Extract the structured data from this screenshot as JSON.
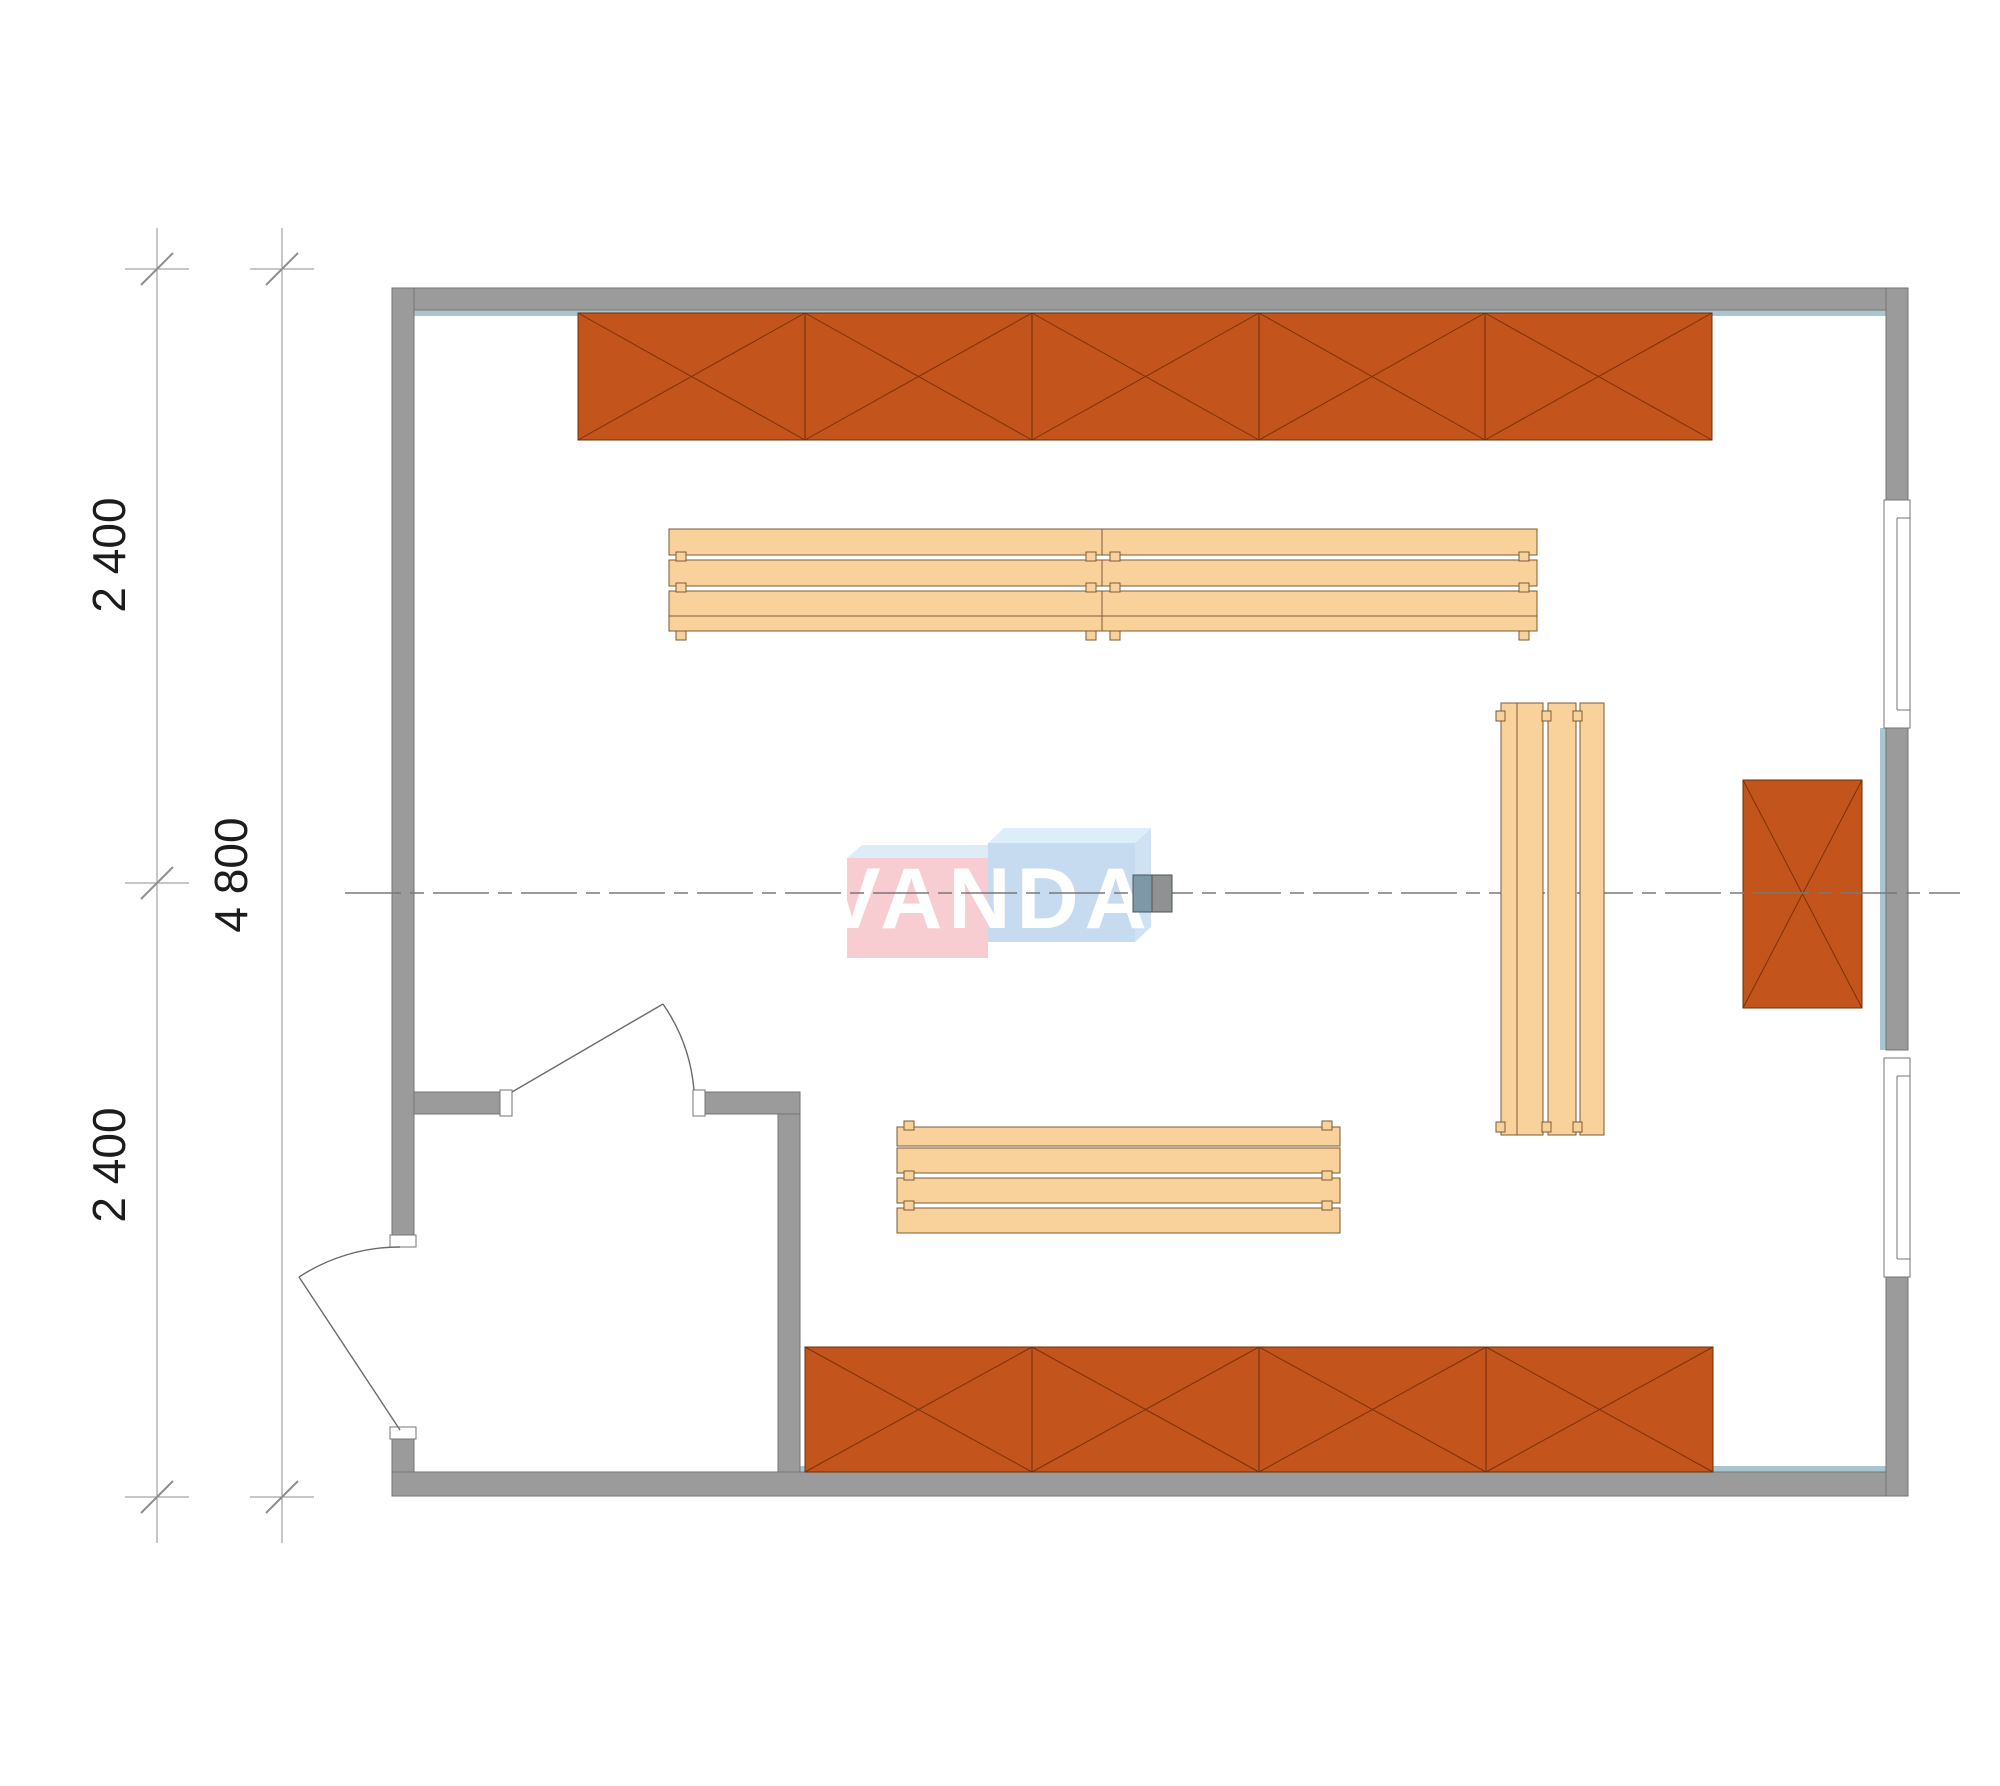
{
  "drawing": {
    "type": "sauna floor plan",
    "view": "top-down"
  },
  "watermark": {
    "text": "VANDA"
  },
  "dimensions": {
    "overall": "4 800",
    "top_segment": "2 400",
    "bottom_segment": "2 400"
  },
  "inventory": {
    "top_cabinet_units": 5,
    "bottom_cabinet_units": 4,
    "wall_cabinet_units": 1,
    "benches": 4,
    "doors": 2,
    "windows": 2
  },
  "colors": {
    "wall": "#9b9b9b",
    "wall_outline": "#747474",
    "cabinet": "#c2541c",
    "cabinet_line": "#7c3208",
    "bench": "#f9d29b",
    "bench_outline": "#7a5a34",
    "lining": "#a9c6d0",
    "logo_pink": "#f7cdd2",
    "logo_pink_top": "#dcedf8",
    "logo_blue": "#c6dbf0",
    "logo_blue_top": "#ddeefb",
    "logo_blue_side": "#cfe2f4",
    "stove_blue": "#7e98a8",
    "stove_gray": "#8f9193"
  }
}
